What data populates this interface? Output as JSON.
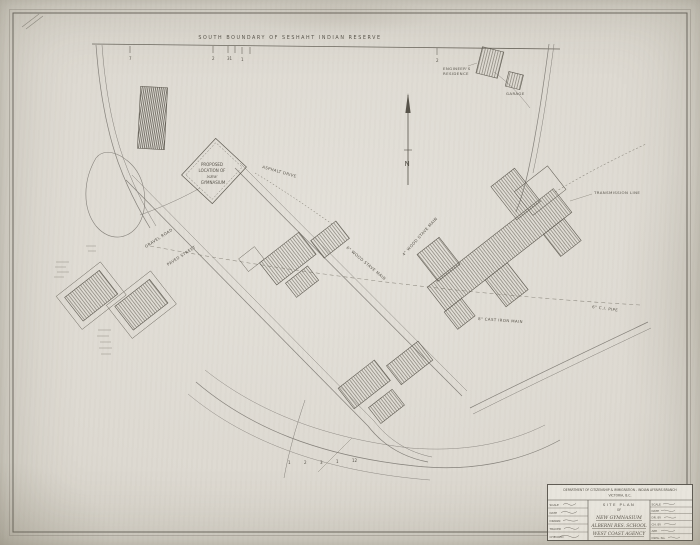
{
  "colors": {
    "paper": "#e0ddd5",
    "paper_edge": "#bfbbb0",
    "ink": "#5f5b52",
    "ink_faint": "#8d897f",
    "hatch": "#6e6a60"
  },
  "boundary_label": "SOUTH  BOUNDARY  OF  SESHAHT  INDIAN  RESERVE",
  "north_label": "N",
  "ticks": {
    "top": [
      "7",
      "2",
      "31",
      "1",
      "2"
    ],
    "bottom": [
      "1",
      "2",
      "3",
      "1",
      "12"
    ]
  },
  "gym_parcel": {
    "l1": "PROPOSED",
    "l2": "LOCATION  OF",
    "l3": "NEW",
    "l4": "GYMNASIUM"
  },
  "labels": {
    "residence_l1": "ENGINEER'S",
    "residence_l2": "RESIDENCE",
    "garage": "GARAGE",
    "transmission": "TRANSMISSION  LINE",
    "asphalt": "ASPHALT  DRIVE",
    "gravel": "GRAVEL  ROAD",
    "paved": "PAVED  STREET",
    "wood_stave": "6\" WOOD STAVE MAIN",
    "wood_stave2": "4\" WOOD STAVE MAIN",
    "cast_iron": "8\" CAST IRON MAIN",
    "ci_pipe": "6\" C.I. PIPE"
  },
  "title_block": {
    "dept_line1": "DEPARTMENT OF CITIZENSHIP & IMMIGRATION - INDIAN AFFAIRS BRANCH",
    "dept_line2": "VICTORIA, B.C.",
    "title1": "SITE PLAN",
    "title2": "OF",
    "title3": "NEW GYMNASIUM",
    "title4": "ALBERNI RES. SCHOOL",
    "title5": "WEST COAST AGENCY",
    "left_fields": [
      {
        "label": "SCALE",
        "value": ""
      },
      {
        "label": "DATE",
        "value": ""
      },
      {
        "label": "DRAWN",
        "value": ""
      },
      {
        "label": "TRACED",
        "value": ""
      },
      {
        "label": "CHECKED",
        "value": ""
      }
    ],
    "right_fields": [
      {
        "label": "SCALE",
        "value": ""
      },
      {
        "label": "DATE",
        "value": ""
      },
      {
        "label": "DR. BY",
        "value": ""
      },
      {
        "label": "CH. BY",
        "value": ""
      },
      {
        "label": "APP.",
        "value": ""
      },
      {
        "label": "DWG. No.",
        "value": ""
      }
    ]
  }
}
